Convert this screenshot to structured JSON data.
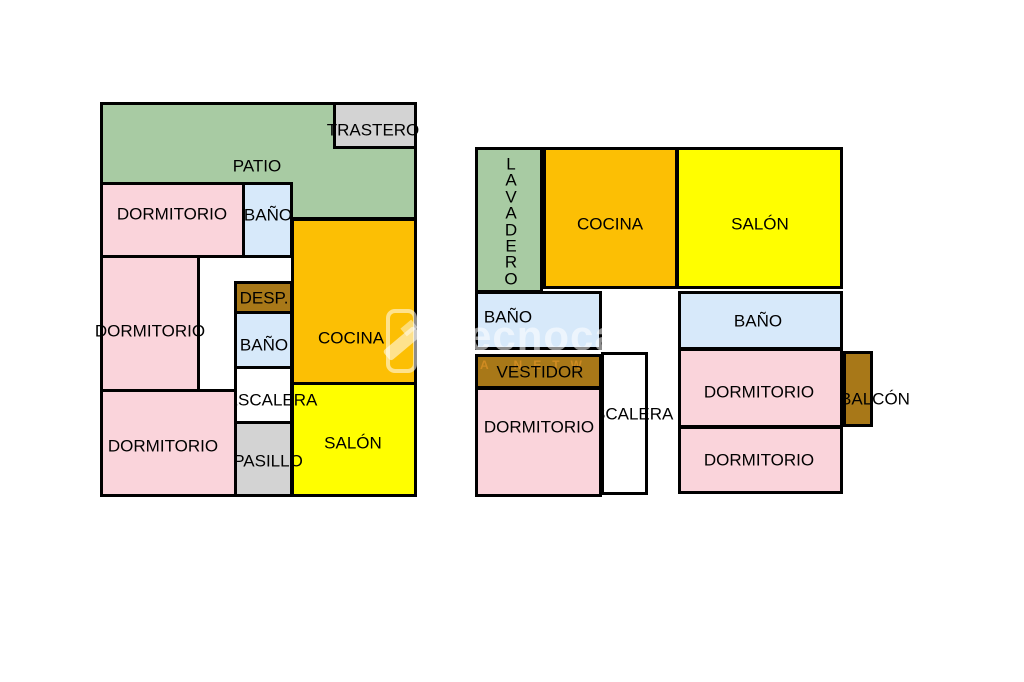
{
  "watermark": {
    "brand": "ecnocasa",
    "tagline": "A NETW"
  },
  "colors": {
    "patio_green": "#a8cba3",
    "kitchen_orange": "#fcbf04",
    "salon_yellow": "#fffe00",
    "bedroom_pink": "#fad4db",
    "bath_blue": "#d7e9fa",
    "storage_gray": "#d3d3d3",
    "wardrobe_brown": "#a87818",
    "stairs_white": "#ffffff",
    "wall_black": "#000000"
  },
  "plans": [
    {
      "name": "floor-plan-left",
      "rooms": [
        {
          "id": "l-patio",
          "label": "PATIO",
          "fill": "#a8cba3",
          "x": 100,
          "y": 102,
          "w": 317,
          "h": 118,
          "z": 1,
          "lx": 257,
          "ly": 166,
          "lz": 8
        },
        {
          "id": "l-trastero",
          "label": "TRASTERO",
          "fill": "#d3d3d3",
          "x": 333,
          "y": 102,
          "w": 84,
          "h": 47,
          "z": 2,
          "lx": 373,
          "ly": 130,
          "lz": 8
        },
        {
          "id": "l-dormitorio-1",
          "label": "DORMITORIO",
          "fill": "#fad4db",
          "x": 100,
          "y": 182,
          "w": 145,
          "h": 76,
          "z": 2,
          "lx": 172,
          "ly": 214,
          "lz": 8
        },
        {
          "id": "l-bano-1",
          "label": "BAÑO",
          "fill": "#d7e9fa",
          "x": 242,
          "y": 182,
          "w": 51,
          "h": 76,
          "z": 2,
          "lx": 268,
          "ly": 215,
          "lz": 8
        },
        {
          "id": "l-cocina",
          "label": "COCINA",
          "fill": "#fcbf04",
          "x": 291,
          "y": 218,
          "w": 126,
          "h": 167,
          "z": 2,
          "lx": 351,
          "ly": 338,
          "lz": 8
        },
        {
          "id": "l-desp",
          "label": "DESP.",
          "fill": "#a87818",
          "x": 234,
          "y": 281,
          "w": 59,
          "h": 33,
          "z": 3,
          "lx": 264,
          "ly": 298,
          "lz": 8
        },
        {
          "id": "l-bano-2",
          "label": "BAÑO",
          "fill": "#d7e9fa",
          "x": 234,
          "y": 311,
          "w": 59,
          "h": 58,
          "z": 3,
          "lx": 264,
          "ly": 345,
          "lz": 8
        },
        {
          "id": "l-escalera",
          "label": "ESCALERA",
          "fill": "#ffffff",
          "x": 234,
          "y": 366,
          "w": 59,
          "h": 58,
          "z": 3,
          "lx": 272,
          "ly": 400,
          "lz": 4
        },
        {
          "id": "l-salon",
          "label": "SALÓN",
          "fill": "#fffe00",
          "x": 291,
          "y": 382,
          "w": 126,
          "h": 115,
          "z": 3,
          "lx": 353,
          "ly": 443,
          "lz": 8
        },
        {
          "id": "l-pasillo",
          "label": "PASILLO",
          "fill": "#d3d3d3",
          "x": 234,
          "y": 421,
          "w": 59,
          "h": 76,
          "z": 3,
          "lx": 268,
          "ly": 461,
          "lz": 4
        },
        {
          "id": "l-dormitorio-2",
          "label": "DORMITORIO",
          "fill": "#fad4db",
          "x": 100,
          "y": 255,
          "w": 100,
          "h": 137,
          "z": 5,
          "lx": 150,
          "ly": 331,
          "lz": 8
        },
        {
          "id": "l-dormitorio-3",
          "label": "DORMITORIO",
          "fill": "#fad4db",
          "x": 100,
          "y": 389,
          "w": 137,
          "h": 108,
          "z": 5,
          "lx": 163,
          "ly": 446,
          "lz": 8
        }
      ]
    },
    {
      "name": "floor-plan-right",
      "rooms": [
        {
          "id": "r-lavadero",
          "label": "LAVADERO",
          "label_lines": "L\nA\nV\nA\nD\nE\nR\nO",
          "vertical": true,
          "fill": "#a8cba3",
          "x": 475,
          "y": 147,
          "w": 68,
          "h": 146,
          "z": 1,
          "lx": 511,
          "ly": 222,
          "lz": 8
        },
        {
          "id": "r-cocina",
          "label": "COCINA",
          "fill": "#fcbf04",
          "x": 543,
          "y": 147,
          "w": 135,
          "h": 142,
          "z": 1,
          "lx": 610,
          "ly": 224,
          "lz": 8
        },
        {
          "id": "r-salon",
          "label": "SALÓN",
          "fill": "#fffe00",
          "x": 676,
          "y": 147,
          "w": 167,
          "h": 142,
          "z": 1,
          "lx": 760,
          "ly": 224,
          "lz": 8
        },
        {
          "id": "r-bano-left",
          "label": "BAÑO",
          "fill": "#d7e9fa",
          "x": 475,
          "y": 291,
          "w": 127,
          "h": 59,
          "z": 2,
          "lx": 508,
          "ly": 317,
          "lz": 8
        },
        {
          "id": "r-bano-right",
          "label": "BAÑO",
          "fill": "#d7e9fa",
          "x": 678,
          "y": 291,
          "w": 165,
          "h": 59,
          "z": 2,
          "lx": 758,
          "ly": 321,
          "lz": 8
        },
        {
          "id": "r-vestidor",
          "label": "VESTIDOR",
          "fill": "#a87818",
          "x": 475,
          "y": 354,
          "w": 127,
          "h": 35,
          "z": 2,
          "lx": 540,
          "ly": 372,
          "lz": 8
        },
        {
          "id": "r-escalera",
          "label": "ESCALERA",
          "fill": "#ffffff",
          "x": 601,
          "y": 352,
          "w": 47,
          "h": 143,
          "z": 2,
          "lx": 628,
          "ly": 414,
          "lz": 4
        },
        {
          "id": "r-dormitorio-1",
          "label": "DORMITORIO",
          "fill": "#fad4db",
          "x": 678,
          "y": 348,
          "w": 165,
          "h": 80,
          "z": 3,
          "lx": 759,
          "ly": 392,
          "lz": 8
        },
        {
          "id": "r-balcon",
          "label": "BALCÓN",
          "fill": "#a87818",
          "x": 843,
          "y": 351,
          "w": 30,
          "h": 76,
          "z": 5,
          "lx": 875,
          "ly": 399,
          "lz": 8
        },
        {
          "id": "r-dormitorio-2",
          "label": "DORMITORIO",
          "fill": "#fad4db",
          "x": 678,
          "y": 426,
          "w": 165,
          "h": 68,
          "z": 3,
          "lx": 759,
          "ly": 460,
          "lz": 8
        },
        {
          "id": "r-dormitorio-left",
          "label": "DORMITORIO",
          "fill": "#fad4db",
          "x": 475,
          "y": 387,
          "w": 127,
          "h": 110,
          "z": 5,
          "lx": 539,
          "ly": 427,
          "lz": 8
        }
      ]
    }
  ]
}
